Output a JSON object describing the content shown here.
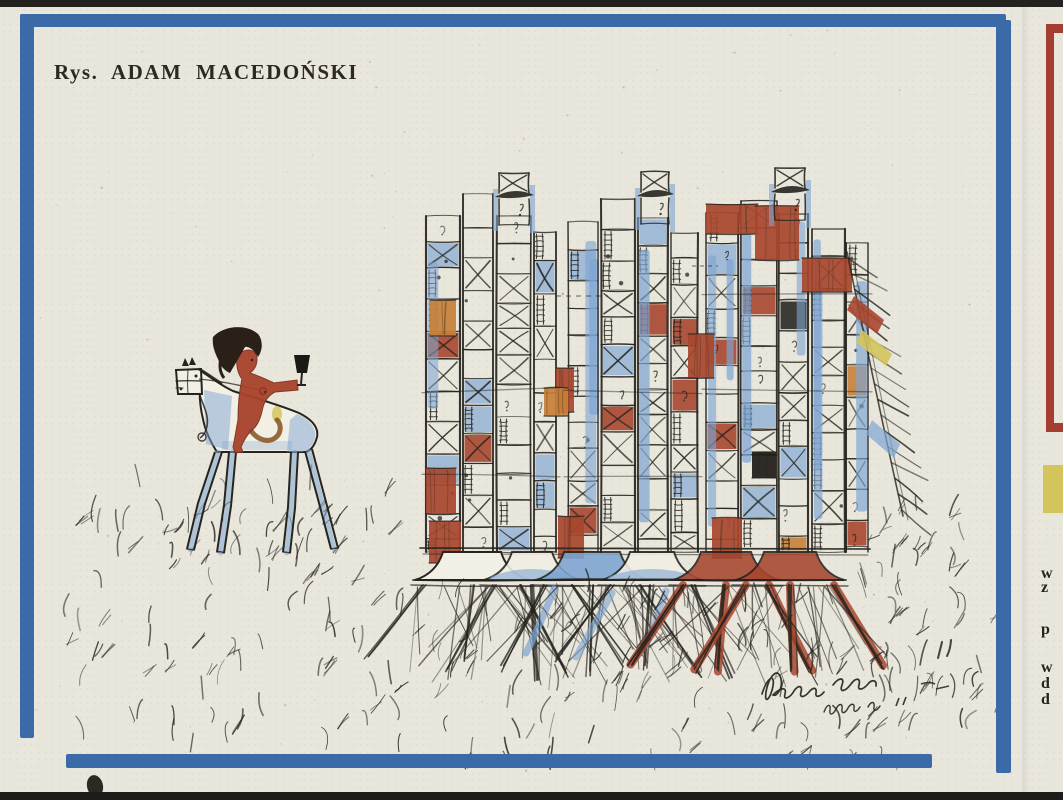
{
  "caption": {
    "text": "Rys. ADAM MACEDOŃSKI"
  },
  "edge_strip": {
    "letters": [
      "w",
      "z",
      "p",
      "w",
      "d",
      "d"
    ]
  },
  "palette": {
    "paper": "#e9e6dc",
    "ink": "#26241e",
    "frame_blue": "#3a6ba8",
    "wash_blue": "#7da5d2",
    "brick": "#a7462e",
    "orange": "#c68038",
    "yellow": "#d3c45c",
    "black_patch": "#1e1c18",
    "hair": "#2a2017",
    "skin": "#a8432c",
    "tail_brown": "#8a5a28",
    "white": "#f2efe5",
    "adjacent_red": "#a33e31",
    "scan_edge": "#23221e"
  }
}
